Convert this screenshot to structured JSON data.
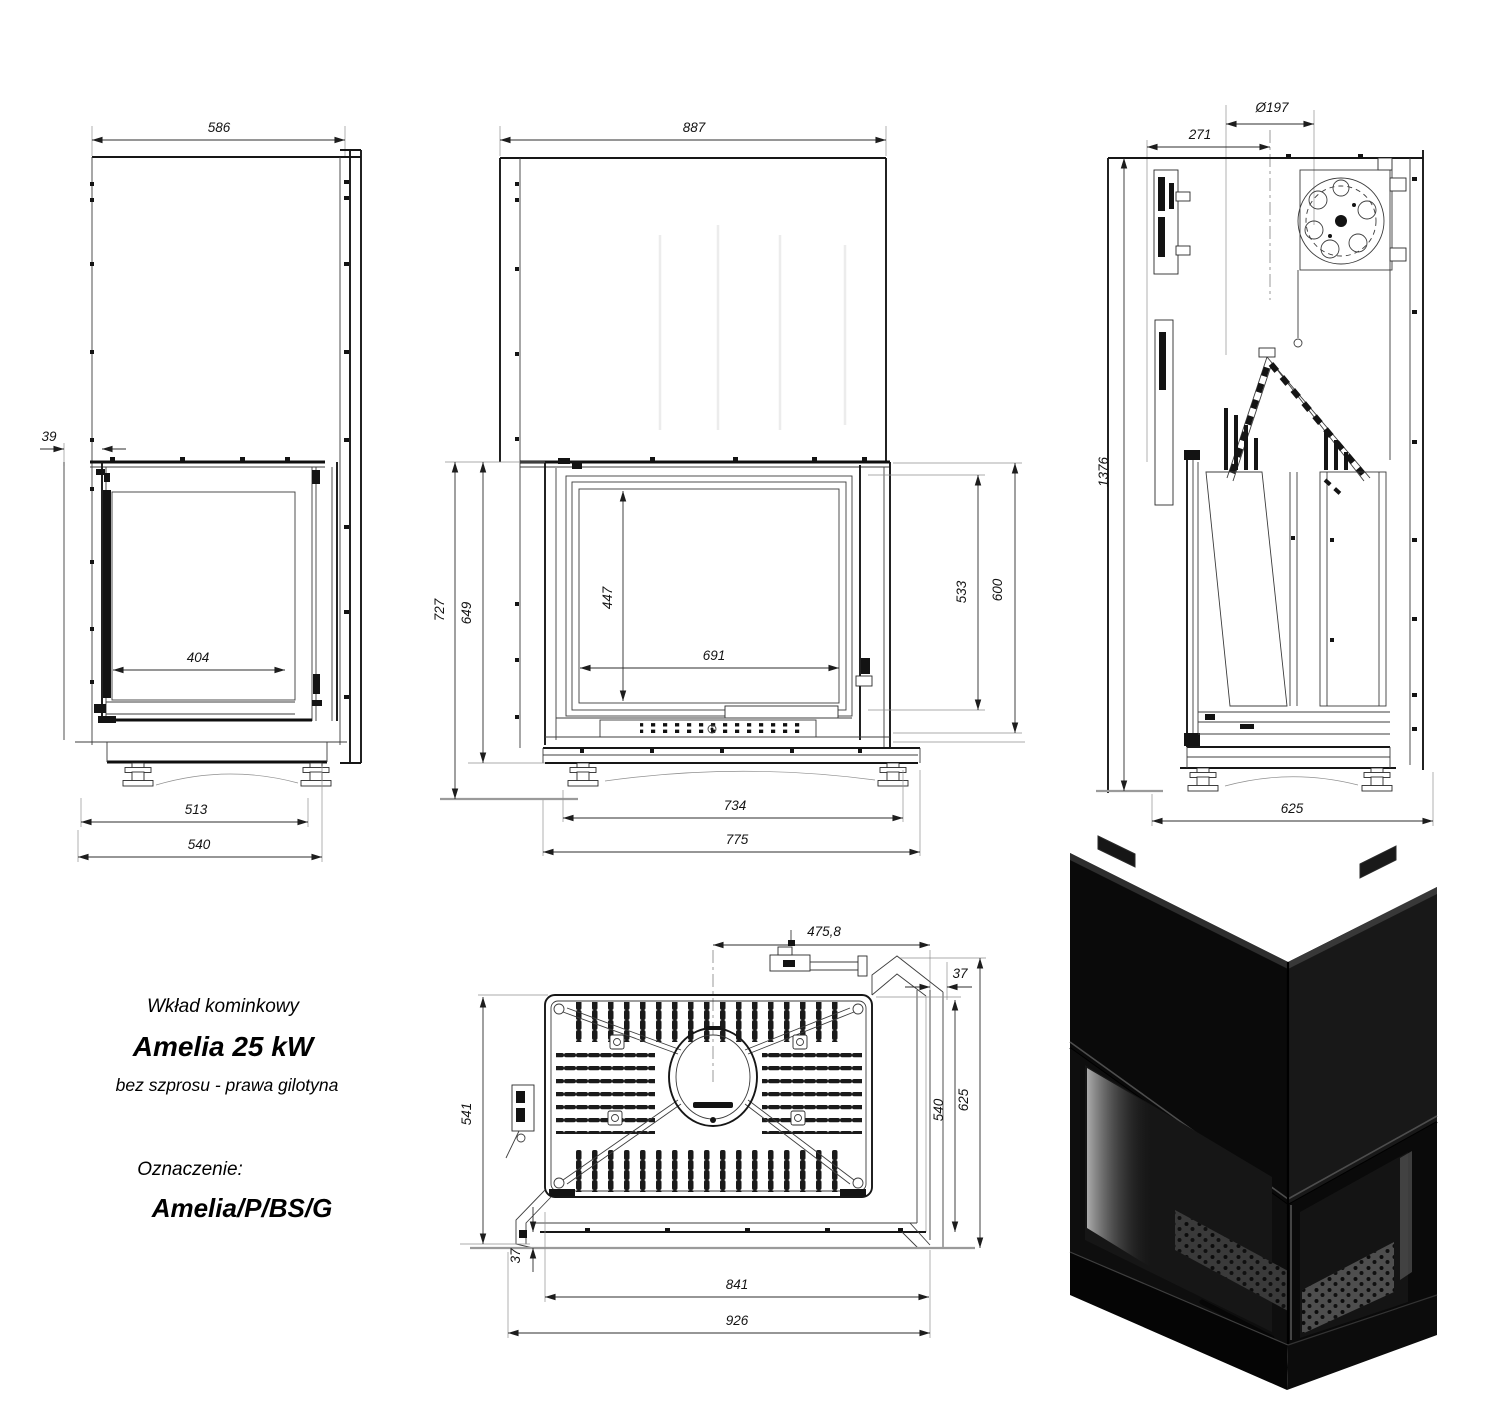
{
  "product": {
    "category": "Wkład kominkowy",
    "model": "Amelia 25 kW",
    "variant": "bez szprosu - prawa gilotyna",
    "designation_label": "Oznaczenie:",
    "designation": "Amelia/P/BS/G"
  },
  "dims": {
    "side": {
      "width": "586",
      "offset": "39",
      "glass": "404",
      "base": "513",
      "total": "540"
    },
    "front": {
      "width": "887",
      "height": "727",
      "body": "649",
      "glass_h": "447",
      "glass_w": "691",
      "opening": "533",
      "door": "600",
      "base": "734",
      "total": "775"
    },
    "section": {
      "flue": "Ø197",
      "offset": "271",
      "height": "1376",
      "depth": "625"
    },
    "plan": {
      "flue_x": "475,8",
      "gap_side": "37",
      "depth_left": "541",
      "depth_right": "540",
      "depth_total": "625",
      "gap_front": "37",
      "width_inner": "841",
      "width_total": "926"
    }
  },
  "colors": {
    "line": "#3c3c3c",
    "dimension_text": "#141414",
    "render_body": "#0b0b0b",
    "background": "#ffffff"
  }
}
